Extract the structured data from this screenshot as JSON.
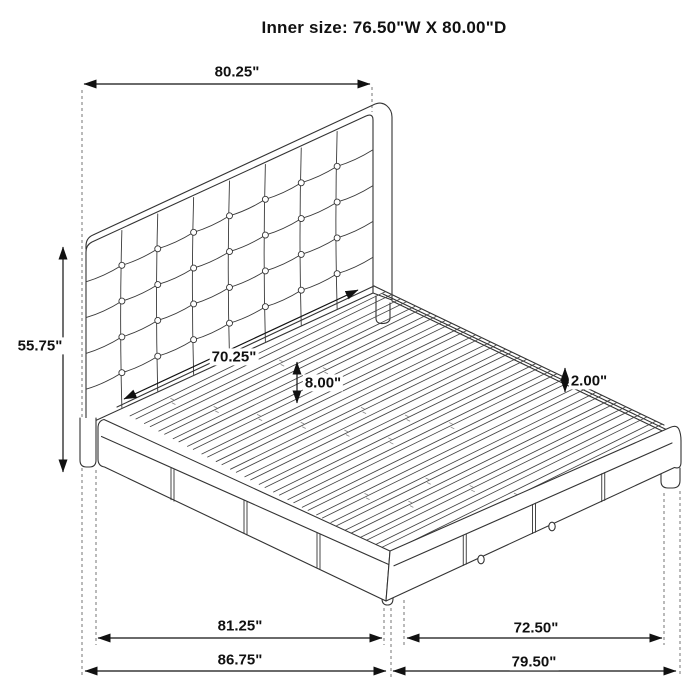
{
  "title": "Inner size: 76.50\"W X 80.00\"D",
  "dimensions": {
    "headboard_width": "80.25\"",
    "headboard_height": "55.75\"",
    "inner_width": "70.25\"",
    "platform_height": "8.00\"",
    "slat_thickness": "2.00\"",
    "side_rail_length": "81.25\"",
    "foot_rail_length": "72.50\"",
    "overall_depth": "86.75\"",
    "overall_width": "79.50\""
  },
  "colors": {
    "line": "#333333",
    "dimension": "#111111",
    "background": "#ffffff"
  }
}
